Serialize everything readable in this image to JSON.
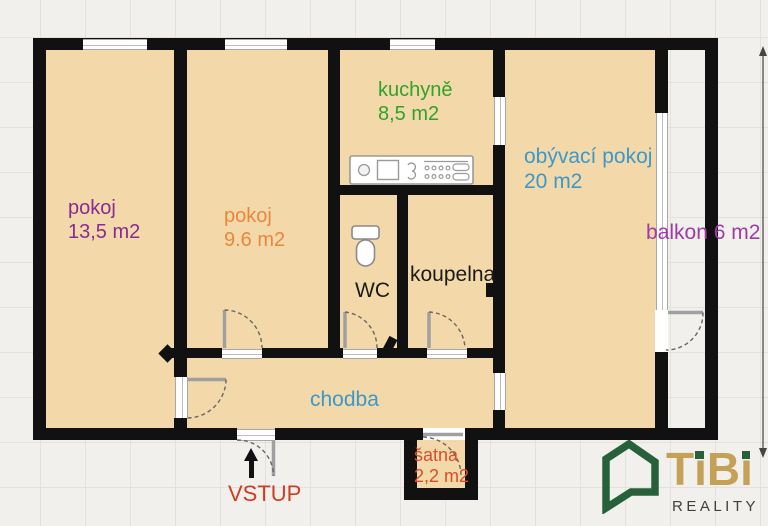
{
  "floorplan": {
    "rooms": [
      {
        "id": "pokoj-13-5",
        "name": "pokoj",
        "area": "13,5 m2",
        "color": "#8a2a95"
      },
      {
        "id": "pokoj-9-6",
        "name": "pokoj",
        "area": "9.6 m2",
        "color": "#e8883c"
      },
      {
        "id": "kuchyne",
        "name": "kuchyně",
        "area": "8,5 m2",
        "color": "#2ea32a"
      },
      {
        "id": "obyvaci-pokoj",
        "name": "obývací pokoj",
        "area": "20 m2",
        "color": "#3d98c9"
      },
      {
        "id": "balkon",
        "name": "balkon",
        "area": "6 m2",
        "color": "#a03ba5"
      },
      {
        "id": "wc",
        "name": "WC",
        "area": "",
        "color": "#1a1a1a"
      },
      {
        "id": "koupelna",
        "name": "koupelna",
        "area": "",
        "color": "#1a1a1a"
      },
      {
        "id": "chodba",
        "name": "chodba",
        "area": "",
        "color": "#3d98c9"
      },
      {
        "id": "satna",
        "name": "šatna",
        "area": "2,2 m2",
        "color": "#d94e2a"
      }
    ],
    "entrance": {
      "label": "VSTUP",
      "color": "#d13b20"
    },
    "colors": {
      "floor": "#f3d9a9",
      "wall": "#111111",
      "outside": "#f2f0ed"
    },
    "logo": {
      "brand_t": "T",
      "brand_i1": "i",
      "brand_b": "B",
      "brand_i2": "i",
      "tagline": "REALITY",
      "gold": "#c5a057",
      "green": "#27613a",
      "gray": "#3f4040"
    }
  }
}
